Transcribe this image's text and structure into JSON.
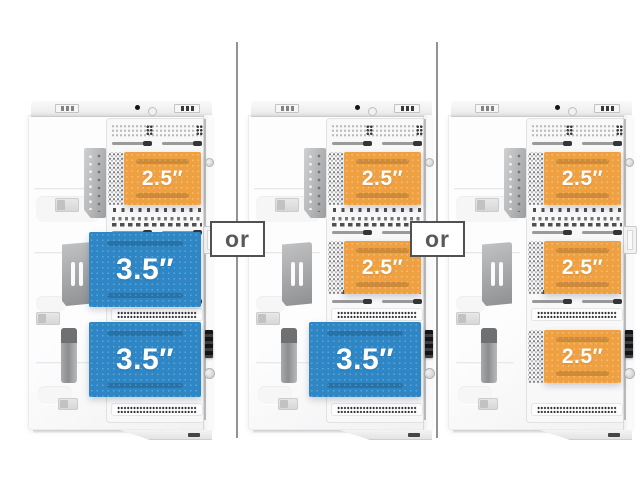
{
  "figure": {
    "description_labels": {
      "ssd_label": "2.5″",
      "hdd_label": "3.5″"
    },
    "colors": {
      "ssd_fill": "#EFA142",
      "hdd_fill": "#2E86C5",
      "or_text": "#58595B",
      "or_border": "#505153",
      "divider_line": "#909294",
      "case_body": "#FDFDFE"
    }
  },
  "separators": [
    {
      "label": "or"
    },
    {
      "label": "or"
    }
  ],
  "cases": [
    {
      "name": "drive-configuration-1",
      "drives": [
        {
          "type": "2.5-inch",
          "label": "2.5″"
        },
        {
          "type": "3.5-inch",
          "label": "3.5″"
        },
        {
          "type": "3.5-inch",
          "label": "3.5″"
        }
      ]
    },
    {
      "name": "drive-configuration-2",
      "drives": [
        {
          "type": "2.5-inch",
          "label": "2.5″"
        },
        {
          "type": "2.5-inch",
          "label": "2.5″"
        },
        {
          "type": "3.5-inch",
          "label": "3.5″"
        }
      ]
    },
    {
      "name": "drive-configuration-3",
      "drives": [
        {
          "type": "2.5-inch",
          "label": "2.5″"
        },
        {
          "type": "2.5-inch",
          "label": "2.5″"
        },
        {
          "type": "2.5-inch",
          "label": "2.5″"
        }
      ]
    }
  ]
}
